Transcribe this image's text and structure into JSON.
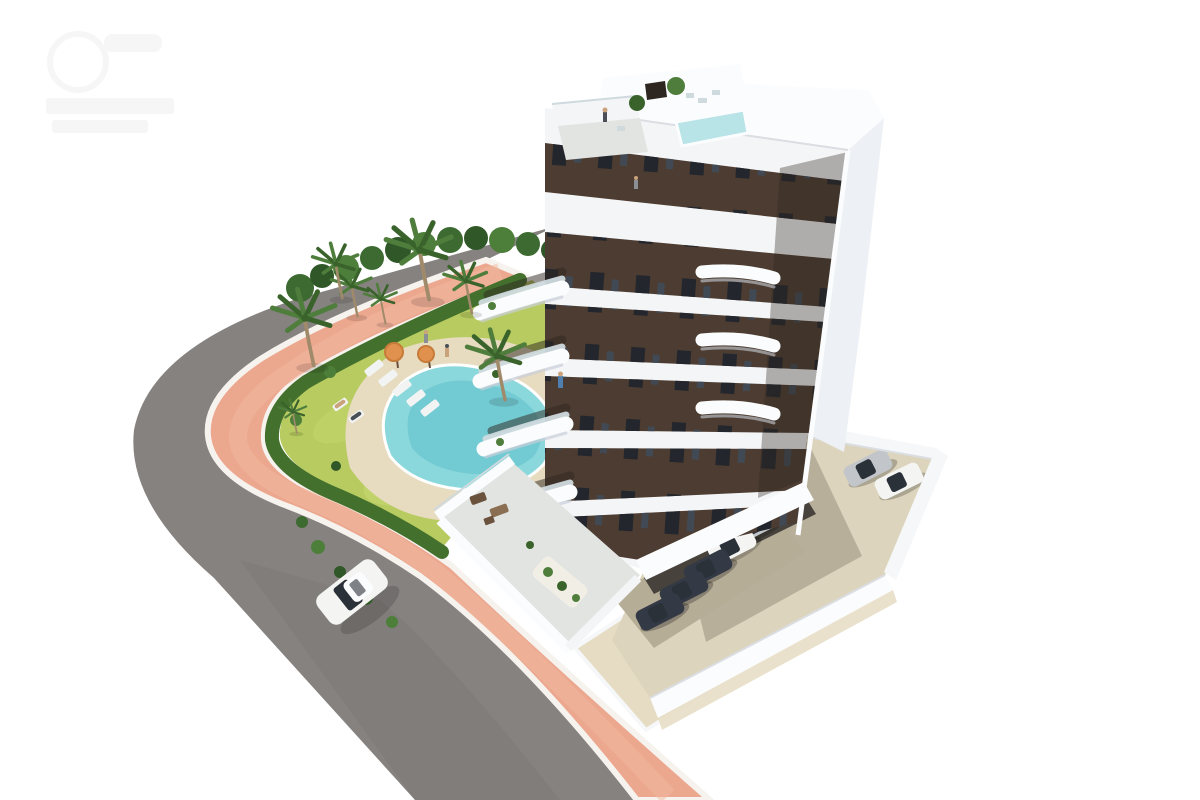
{
  "scene": {
    "type": "architectural-rendering",
    "view": "aerial-three-quarter",
    "description": "New-build apartment tower with dark brown facade and white wraparound balconies, rooftop plunge pool and terraces, landscaped garden with free-form swimming pool, sun loungers, parasols and palm trees, a salmon-pink promenade along a curved asphalt road with one white car, and a residents' parking court with parked cars",
    "watermark": {
      "present": true,
      "text_legible": false,
      "position": "top-left"
    }
  },
  "inventory": {
    "building": {
      "floors_visible": 7,
      "facade": "dark brown with white curved balcony bands",
      "rooftop_pool": true,
      "rooftop_terraces": 2
    },
    "garden": {
      "pool_shape": "freeform",
      "sun_loungers": 5,
      "parasols": 2,
      "palm_trees": 8
    },
    "vehicles": {
      "driving_on_road": 1,
      "parked_open_lot": 2,
      "parked_under_building": 5
    },
    "people_visible": 7
  },
  "palette": {
    "background": "#ffffff",
    "watermark": "#efefef",
    "road": "#868280",
    "road_shade": "#7b7774",
    "curb": "#f6f3ee",
    "sidewalk": "#eca78f",
    "sidewalk_light": "#f2b9a2",
    "walkway": "#e5dcc3",
    "ramp_dark": "#23262b",
    "ramp_stripe": "#6e737a",
    "wall_white": "#f6f7f8",
    "wall_shade": "#dadde2",
    "grass": "#b7cb60",
    "grass_light": "#c9da74",
    "hedge": "#44702e",
    "shrub_dark": "#2f5727",
    "shrub_mid": "#3c6a31",
    "shrub_light": "#4d7f3b",
    "deck": "#e7dbc0",
    "pool_deep": "#5fc0cb",
    "pool_mid": "#8bd8dc",
    "pool_light": "#b3e7e9",
    "pool_rim": "#ffffff",
    "rooftop_pool": "#b8e4e8",
    "towel": "#f2f4f4",
    "umbrella": "#e0914d",
    "umbrella_dark": "#c77b39",
    "furniture_brown": "#6b523c",
    "furniture_light": "#8a6f52",
    "person_tan": "#caa27c",
    "person_grey": "#8a8f96",
    "person_blue": "#4f7fae",
    "person_dark": "#4a4f57",
    "parking": "#dcd4bc",
    "parking_shade": "#8b8270",
    "undercroft": "#b6ad97",
    "undercroft_dark": "#34302c",
    "car_white": "#f4f5f3",
    "car_silver": "#c2c6ca",
    "car_dark": "#333945",
    "car_glass": "#2b3138",
    "shadow": "#000000",
    "side_wall": "#edf0f4",
    "white_wall": "#f4f5f7",
    "white_bright": "#fbfcfd",
    "white_shade": "#c9cfd8",
    "glass_rail": "#cfdade",
    "facade_brown": "#4c3c31",
    "facade_dark": "#2e2620",
    "window_glass": "#23262c",
    "window_reflect": "#414a54",
    "terrace_floor": "#e2e4e2",
    "pebble": "#f1eee6",
    "palm_trunk": "#a08a6a",
    "palm_green": "#4e7d3c",
    "palm_green_dark": "#3a632c"
  }
}
